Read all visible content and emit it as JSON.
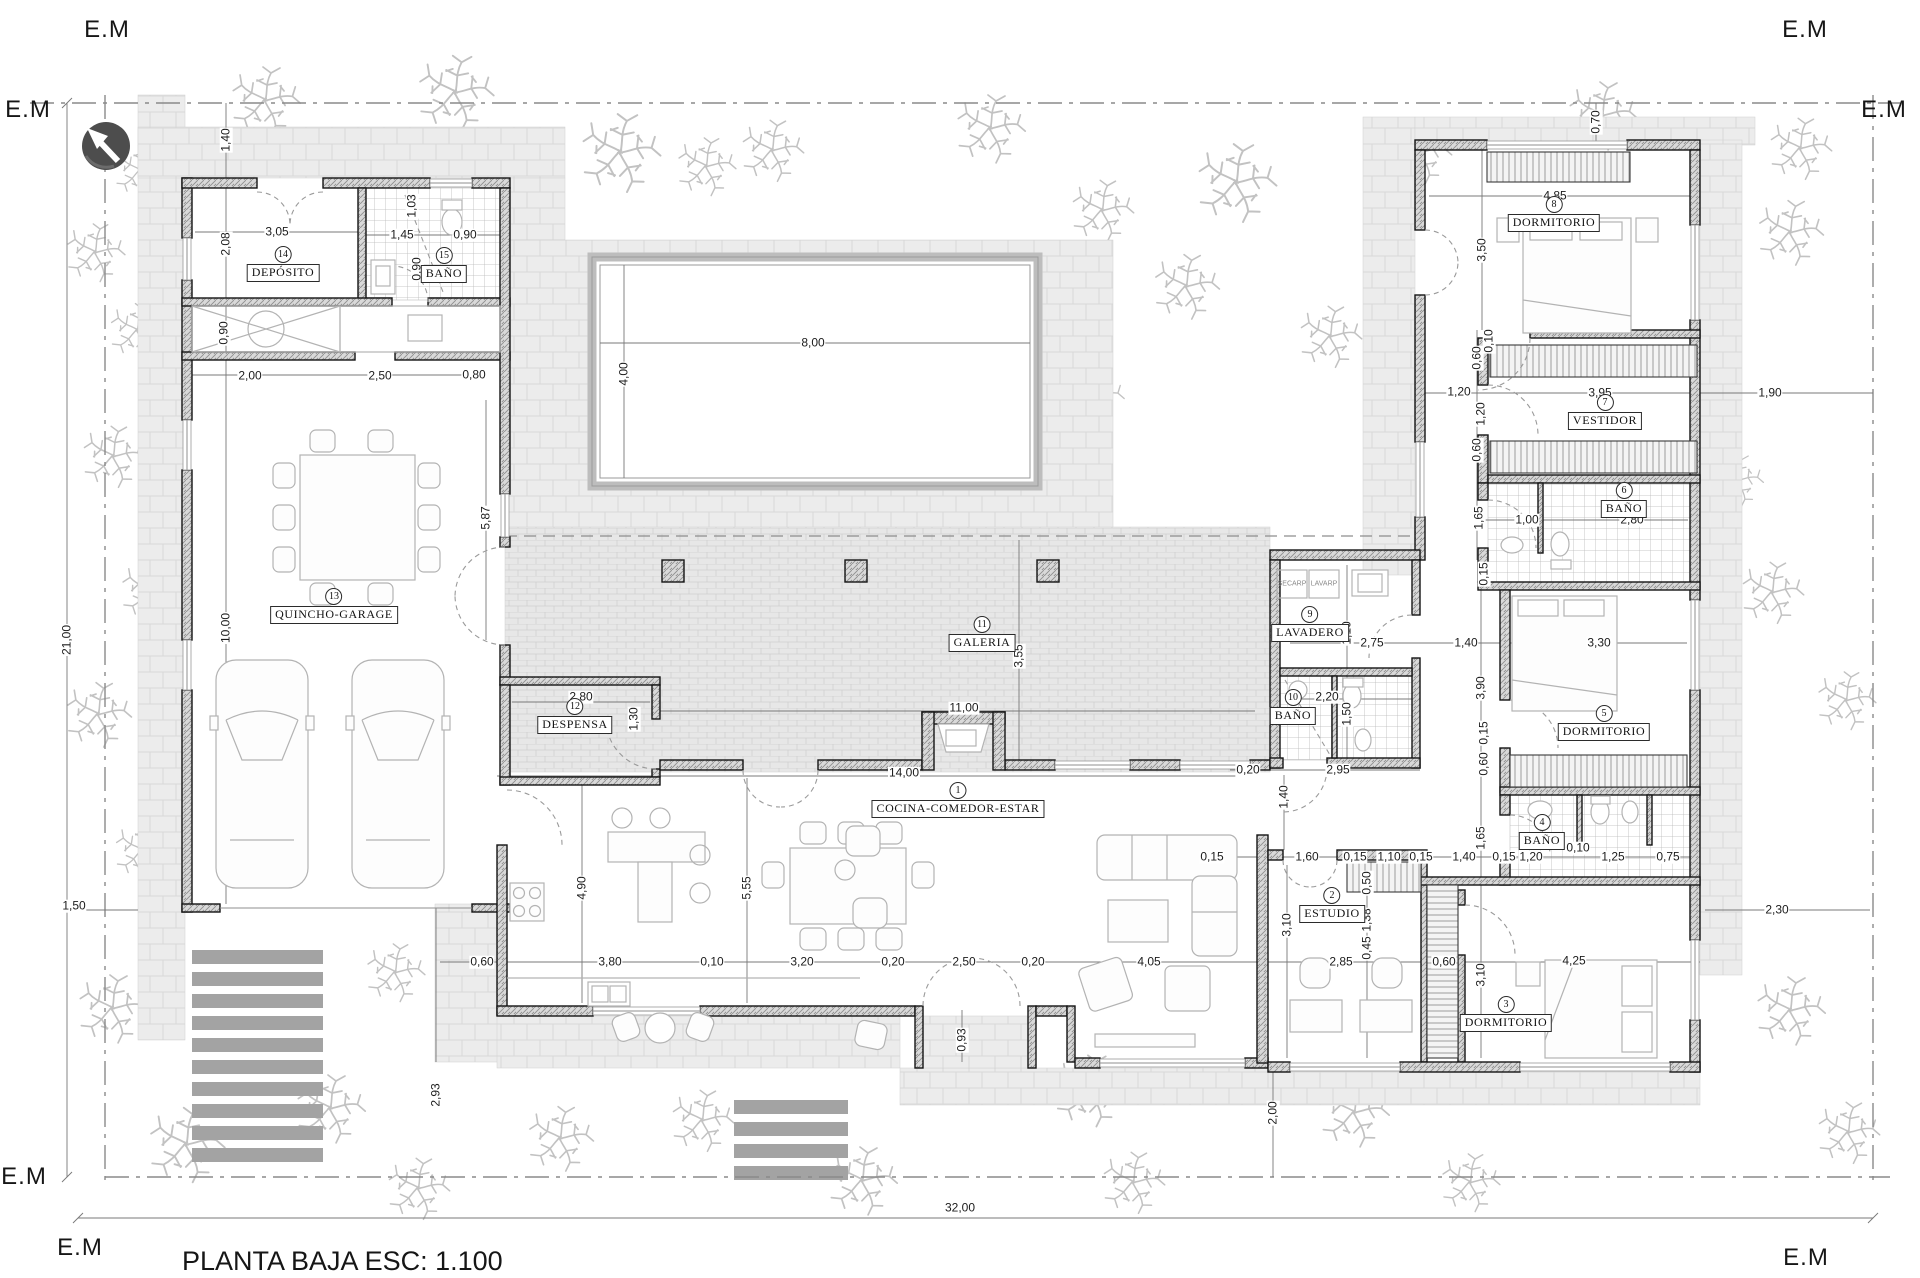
{
  "title": "PLANTA BAJA ESC: 1.100",
  "em_label": "E.M",
  "colors": {
    "background": "#ffffff",
    "wall_hatch": "#d6d6d6",
    "wall_edge": "#141414",
    "paving": "#ececec",
    "galeria_brick": "#e7e7e7",
    "deck_bar": "#a3a3a3",
    "tree": "#c2c2c2",
    "dimension_text": "#1c1c1c",
    "north_arrow_circle": "#4d4d4d"
  },
  "icons": {
    "north_arrow": "north-arrow-icon"
  },
  "rooms": [
    {
      "num": "1",
      "name": "COCINA-COMEDOR-ESTAR",
      "x": 958,
      "y": 800
    },
    {
      "num": "2",
      "name": "ESTUDIO",
      "x": 1332,
      "y": 905
    },
    {
      "num": "3",
      "name": "DORMITORIO",
      "x": 1506,
      "y": 1014
    },
    {
      "num": "4",
      "name": "BAÑO",
      "x": 1542,
      "y": 832
    },
    {
      "num": "5",
      "name": "DORMITORIO",
      "x": 1604,
      "y": 723
    },
    {
      "num": "6",
      "name": "BAÑO",
      "x": 1624,
      "y": 500
    },
    {
      "num": "7",
      "name": "VESTIDOR",
      "x": 1605,
      "y": 412
    },
    {
      "num": "8",
      "name": "DORMITORIO",
      "x": 1554,
      "y": 214
    },
    {
      "num": "9",
      "name": "LAVADERO",
      "x": 1310,
      "y": 624
    },
    {
      "num": "10",
      "name": "BAÑO",
      "x": 1293,
      "y": 707
    },
    {
      "num": "11",
      "name": "GALERIA",
      "x": 982,
      "y": 634
    },
    {
      "num": "12",
      "name": "DESPENSA",
      "x": 575,
      "y": 716
    },
    {
      "num": "13",
      "name": "QUINCHO-GARAGE",
      "x": 334,
      "y": 606
    },
    {
      "num": "14",
      "name": "DEPÓSITO",
      "x": 283,
      "y": 264
    },
    {
      "num": "15",
      "name": "BAÑO",
      "x": 444,
      "y": 265
    }
  ],
  "appliances": [
    {
      "t": "SECARP",
      "x": 1292,
      "y": 584,
      "r": 0,
      "s": 1
    },
    {
      "t": "LAVARP",
      "x": 1324,
      "y": 584,
      "r": 0,
      "s": 1
    }
  ],
  "dims": [
    {
      "t": "21,00",
      "x": 67,
      "y": 640,
      "r": 1
    },
    {
      "t": "32,00",
      "x": 960,
      "y": 1208,
      "r": 0
    },
    {
      "t": "1,40",
      "x": 226,
      "y": 140,
      "r": 1
    },
    {
      "t": "2,08",
      "x": 226,
      "y": 244,
      "r": 1
    },
    {
      "t": "3,05",
      "x": 277,
      "y": 232,
      "r": 0
    },
    {
      "t": "1,45",
      "x": 402,
      "y": 235,
      "r": 0
    },
    {
      "t": "0,90",
      "x": 465,
      "y": 235,
      "r": 0
    },
    {
      "t": "1,03",
      "x": 412,
      "y": 206,
      "r": 1
    },
    {
      "t": "0,90",
      "x": 417,
      "y": 269,
      "r": 1
    },
    {
      "t": "0,90",
      "x": 224,
      "y": 333,
      "r": 1
    },
    {
      "t": "2,00",
      "x": 250,
      "y": 376,
      "r": 0
    },
    {
      "t": "2,50",
      "x": 380,
      "y": 376,
      "r": 0
    },
    {
      "t": "0,80",
      "x": 474,
      "y": 375,
      "r": 0
    },
    {
      "t": "10,00",
      "x": 226,
      "y": 628,
      "r": 1
    },
    {
      "t": "5,87",
      "x": 486,
      "y": 518,
      "r": 1
    },
    {
      "t": "8,00",
      "x": 813,
      "y": 343,
      "r": 0
    },
    {
      "t": "4,00",
      "x": 624,
      "y": 374,
      "r": 1
    },
    {
      "t": "1,50",
      "x": 74,
      "y": 906,
      "r": 0
    },
    {
      "t": "2,80",
      "x": 581,
      "y": 697,
      "r": 0
    },
    {
      "t": "1,30",
      "x": 634,
      "y": 719,
      "r": 1
    },
    {
      "t": "5,55",
      "x": 747,
      "y": 888,
      "r": 1
    },
    {
      "t": "4,90",
      "x": 582,
      "y": 888,
      "r": 1
    },
    {
      "t": "3,55",
      "x": 1019,
      "y": 656,
      "r": 1
    },
    {
      "t": "11,00",
      "x": 964,
      "y": 708,
      "r": 0
    },
    {
      "t": "14,00",
      "x": 904,
      "y": 773,
      "r": 0
    },
    {
      "t": "0,60",
      "x": 482,
      "y": 962,
      "r": 0
    },
    {
      "t": "3,80",
      "x": 610,
      "y": 962,
      "r": 0
    },
    {
      "t": "0,10",
      "x": 712,
      "y": 962,
      "r": 0
    },
    {
      "t": "3,20",
      "x": 802,
      "y": 962,
      "r": 0
    },
    {
      "t": "0,20",
      "x": 893,
      "y": 962,
      "r": 0
    },
    {
      "t": "2,50",
      "x": 964,
      "y": 962,
      "r": 0
    },
    {
      "t": "0,20",
      "x": 1033,
      "y": 962,
      "r": 0
    },
    {
      "t": "4,05",
      "x": 1149,
      "y": 962,
      "r": 0
    },
    {
      "t": "2,85",
      "x": 1341,
      "y": 962,
      "r": 0
    },
    {
      "t": "0,60",
      "x": 1444,
      "y": 962,
      "r": 0
    },
    {
      "t": "4,25",
      "x": 1574,
      "y": 961,
      "r": 0
    },
    {
      "t": "2,93",
      "x": 436,
      "y": 1095,
      "r": 1
    },
    {
      "t": "0,93",
      "x": 962,
      "y": 1040,
      "r": 1
    },
    {
      "t": "0,20",
      "x": 1248,
      "y": 770,
      "r": 0
    },
    {
      "t": "2,95",
      "x": 1338,
      "y": 770,
      "r": 0
    },
    {
      "t": "1,40",
      "x": 1284,
      "y": 797,
      "r": 1
    },
    {
      "t": "0,15",
      "x": 1212,
      "y": 857,
      "r": 0
    },
    {
      "t": "1,60",
      "x": 1307,
      "y": 857,
      "r": 0
    },
    {
      "t": "0,15",
      "x": 1355,
      "y": 857,
      "r": 0
    },
    {
      "t": "1,10",
      "x": 1389,
      "y": 857,
      "r": 0
    },
    {
      "t": "0,15",
      "x": 1421,
      "y": 857,
      "r": 0
    },
    {
      "t": "1,40",
      "x": 1464,
      "y": 857,
      "r": 0
    },
    {
      "t": "0,15",
      "x": 1504,
      "y": 857,
      "r": 0
    },
    {
      "t": "1,20",
      "x": 1531,
      "y": 857,
      "r": 0
    },
    {
      "t": "0,10",
      "x": 1578,
      "y": 848,
      "r": 0
    },
    {
      "t": "1,25",
      "x": 1613,
      "y": 857,
      "r": 0
    },
    {
      "t": "0,75",
      "x": 1668,
      "y": 857,
      "r": 0
    },
    {
      "t": "1,65",
      "x": 1481,
      "y": 838,
      "r": 1
    },
    {
      "t": "3,10",
      "x": 1287,
      "y": 925,
      "r": 1
    },
    {
      "t": "0,50",
      "x": 1367,
      "y": 883,
      "r": 1
    },
    {
      "t": "1,38",
      "x": 1367,
      "y": 920,
      "r": 1
    },
    {
      "t": "0,45",
      "x": 1367,
      "y": 948,
      "r": 1
    },
    {
      "t": "3,10",
      "x": 1481,
      "y": 975,
      "r": 1
    },
    {
      "t": "2,20",
      "x": 1327,
      "y": 697,
      "r": 0
    },
    {
      "t": "1,50",
      "x": 1347,
      "y": 714,
      "r": 1
    },
    {
      "t": "1,10",
      "x": 1347,
      "y": 633,
      "r": 1
    },
    {
      "t": "2,75",
      "x": 1372,
      "y": 643,
      "r": 0
    },
    {
      "t": "1,40",
      "x": 1466,
      "y": 643,
      "r": 0
    },
    {
      "t": "3,30",
      "x": 1599,
      "y": 643,
      "r": 0
    },
    {
      "t": "3,90",
      "x": 1481,
      "y": 688,
      "r": 1
    },
    {
      "t": "0,15",
      "x": 1484,
      "y": 733,
      "r": 1
    },
    {
      "t": "0,60",
      "x": 1484,
      "y": 764,
      "r": 1
    },
    {
      "t": "0,15",
      "x": 1484,
      "y": 574,
      "r": 1
    },
    {
      "t": "0,70",
      "x": 1596,
      "y": 122,
      "r": 1
    },
    {
      "t": "4,85",
      "x": 1555,
      "y": 196,
      "r": 0
    },
    {
      "t": "3,50",
      "x": 1482,
      "y": 250,
      "r": 1
    },
    {
      "t": "0,60",
      "x": 1477,
      "y": 358,
      "r": 1
    },
    {
      "t": "0,10",
      "x": 1489,
      "y": 341,
      "r": 1
    },
    {
      "t": "1,20",
      "x": 1459,
      "y": 392,
      "r": 0
    },
    {
      "t": "1,20",
      "x": 1481,
      "y": 414,
      "r": 1
    },
    {
      "t": "3,95",
      "x": 1600,
      "y": 393,
      "r": 0
    },
    {
      "t": "1,90",
      "x": 1770,
      "y": 393,
      "r": 0
    },
    {
      "t": "0,60",
      "x": 1477,
      "y": 450,
      "r": 1
    },
    {
      "t": "1,65",
      "x": 1479,
      "y": 518,
      "r": 1
    },
    {
      "t": "1,00",
      "x": 1527,
      "y": 520,
      "r": 0
    },
    {
      "t": "2,80",
      "x": 1632,
      "y": 520,
      "r": 0
    },
    {
      "t": "2,30",
      "x": 1777,
      "y": 910,
      "r": 0
    },
    {
      "t": "2,00",
      "x": 1273,
      "y": 1113,
      "r": 1
    }
  ]
}
